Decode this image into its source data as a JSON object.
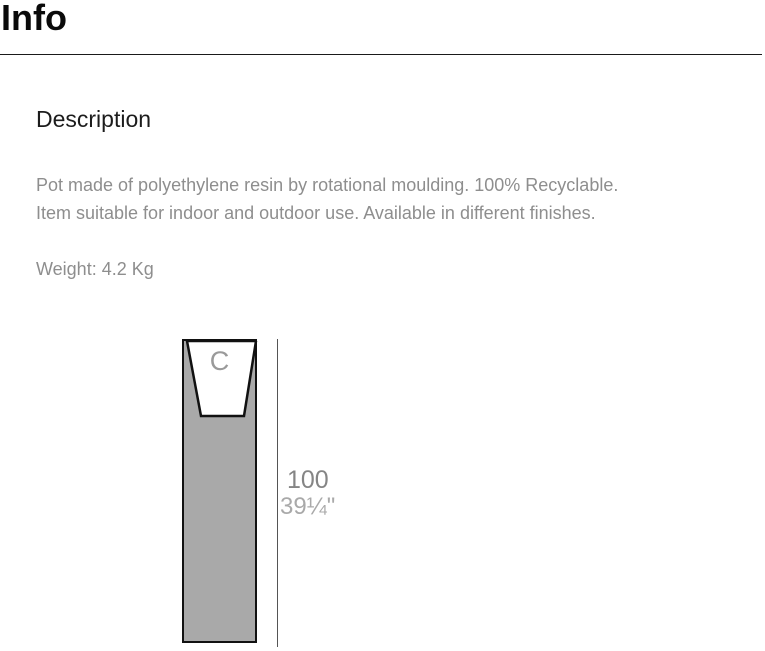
{
  "header": {
    "title": "Info"
  },
  "main": {
    "section_title": "Description",
    "description_lines": [
      "Pot made of polyethylene resin by rotational moulding. 100% Recyclable.",
      "Item suitable for indoor and outdoor use. Available in different finishes."
    ],
    "weight_text": "Weight: 4.2 Kg"
  },
  "diagram": {
    "cavity_label": "C",
    "height_cm": "100",
    "height_inches": "39¼\"",
    "colors": {
      "pot_fill": "#a9a9a9",
      "outline": "#111111",
      "cavity_fill": "#ffffff",
      "dimension_line": "#555555",
      "label_cm": "#858585",
      "label_inches": "#a9a9a9",
      "text_gray": "#8e8e8e"
    }
  }
}
